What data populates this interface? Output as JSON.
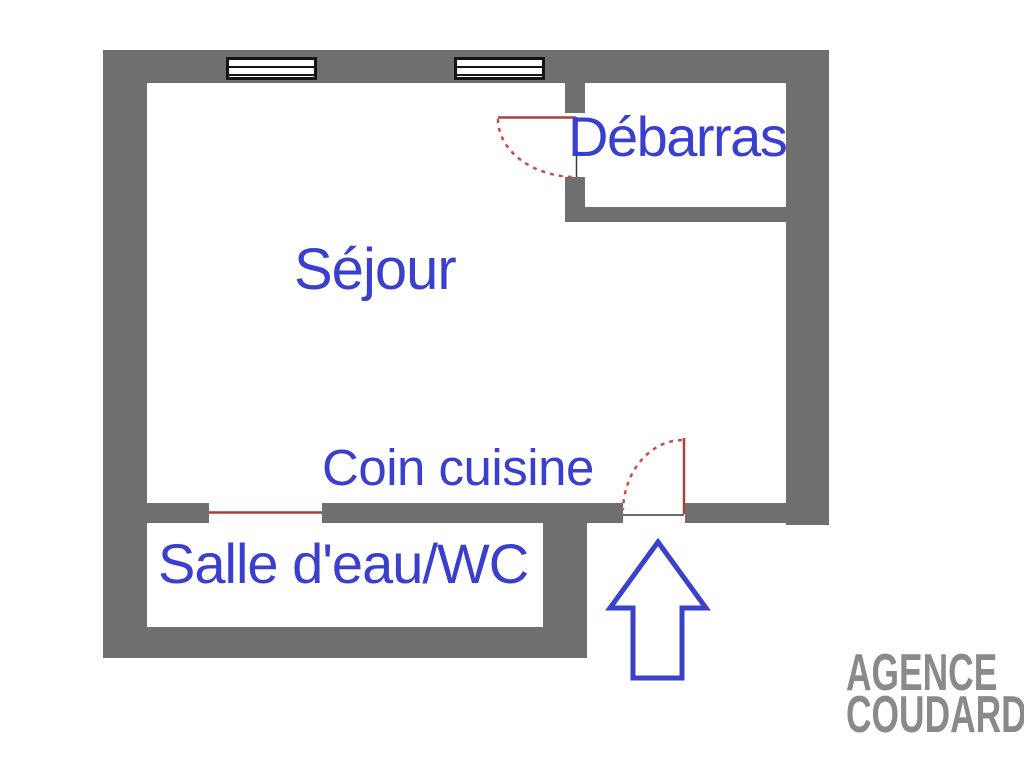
{
  "rooms": {
    "sejour": {
      "label": "Séjour"
    },
    "debarras": {
      "label": "Débarras"
    },
    "coin_cuisine": {
      "label": "Coin cuisine"
    },
    "salle_eau_wc": {
      "label": "Salle d'eau/WC"
    }
  },
  "watermark": {
    "line1": "AGENCE",
    "line2": "COUDARD"
  },
  "colors": {
    "wall": "#6f6f6f",
    "room_label": "#3b3fcd",
    "door": "#aa403c",
    "door_swing": "#c0504d",
    "threshold": "#3a3a3a",
    "entry_arrow": "#3a42cc",
    "window_frame": "#141414",
    "watermark": "#8a8a8a"
  }
}
